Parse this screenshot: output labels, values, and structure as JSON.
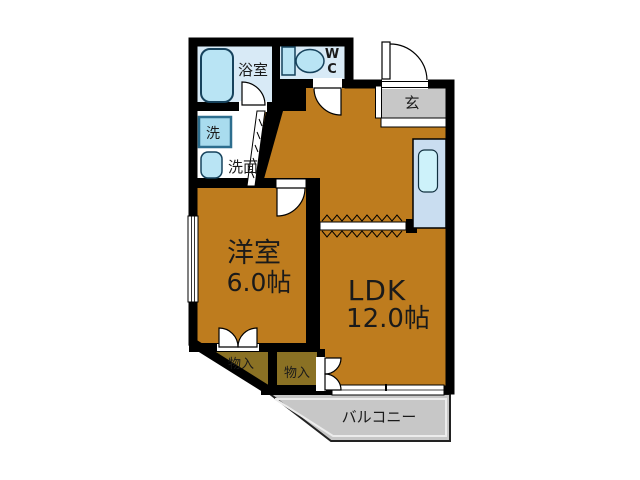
{
  "title": "apartment-floor-plan",
  "rooms": {
    "bath": {
      "label": "浴室"
    },
    "wc": {
      "line1": "W",
      "line2": "C"
    },
    "entrance": {
      "label": "玄"
    },
    "laundry": {
      "label": "洗"
    },
    "washroom": {
      "label": "洗面"
    },
    "western_room": {
      "label": "洋室",
      "size": "6.0帖"
    },
    "ldk": {
      "label": "LDK",
      "size": "12.0帖"
    },
    "storage1": {
      "label": "物入"
    },
    "storage2": {
      "label": "物入"
    },
    "balcony": {
      "label": "バルコニー"
    }
  },
  "fixtures": {
    "bathtub": "bathtub-icon",
    "toilet": "toilet-icon",
    "washing_machine": "washing-machine-icon",
    "washbasin": "washbasin-icon",
    "kitchen_sink": "kitchen-sink-icon"
  },
  "colors": {
    "wall": "#000000",
    "room_floor": "#BE7C1E",
    "storage_floor": "#8A7124",
    "wet_area_floor": "#D8EAF6",
    "fixture_blue": "#B9E4F4",
    "washer_blue": "#A9DCEE",
    "kitchen_counter": "#C9DDF0",
    "kitchen_sink": "#CDF2FA",
    "entrance_gray": "#C7C7C7",
    "balcony_gray": "#C7C7C7",
    "text": "#1A1A1A",
    "background": "#FFFFFF"
  }
}
